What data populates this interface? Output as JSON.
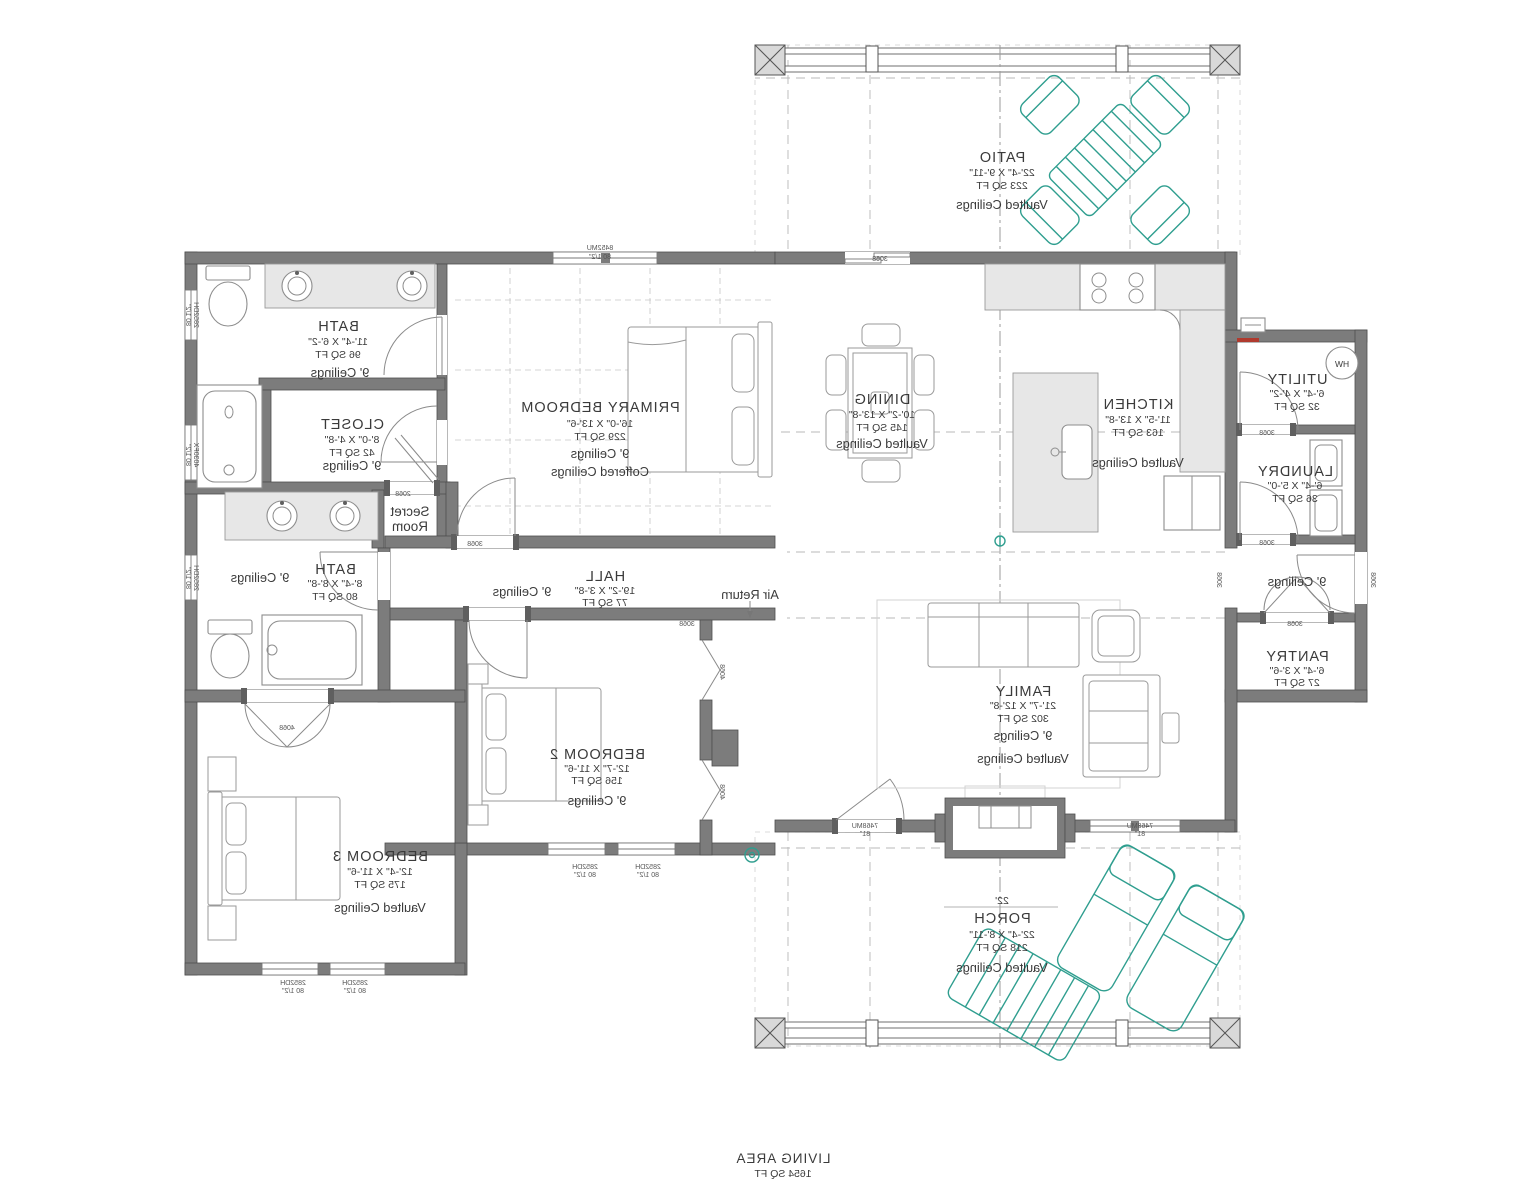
{
  "plan": {
    "rooms": {
      "bath_primary": {
        "name": "BATH",
        "dims": "11'-4\" X 6'-2\"",
        "area": "96 SQ FT",
        "ceiling": "9' Ceilings"
      },
      "closet_primary": {
        "name": "CLOSET",
        "dims": "8'-0\" X 4'-8\"",
        "area": "42 SQ FT",
        "ceiling": "9' Ceilings"
      },
      "secret_room": {
        "line1": "Secret",
        "line2": "Room"
      },
      "primary_bedroom": {
        "name": "PRIMARY BEDROOM",
        "dims": "16'-0\" X 13'-6\"",
        "area": "229 SQ FT",
        "ceiling": "9' Ceilings",
        "ceiling2": "Coffered Ceilings"
      },
      "hall": {
        "name": "HALL",
        "dims": "19'-2\" X 3'-8\"",
        "area": "77 SQ FT",
        "ceiling": "9' Ceilings"
      },
      "bath2": {
        "name": "BATH",
        "dims": "8'-4\" X 8'-8\"",
        "area": "80 SQ FT",
        "ceiling": "9' Ceilings"
      },
      "bedroom2": {
        "name": "BEDROOM 2",
        "dims": "12'-7\" X 11'-6\"",
        "area": "156 SQ FT",
        "ceiling": "9' Ceilings"
      },
      "bedroom3": {
        "name": "BEDROOM 3",
        "dims": "12'-4\" X 11'-6\"",
        "area": "175 SQ FT",
        "ceiling": "Vaulted Ceilings"
      },
      "dining": {
        "name": "DINING",
        "dims": "10'-2\" X 13'-8\"",
        "area": "145 SQ FT",
        "ceiling": "Vaulted Ceilings"
      },
      "kitchen": {
        "name": "KITCHEN",
        "dims": "11'-5\" X 13'-8\"",
        "area": "163 SQ FT",
        "ceiling": "Vaulted Ceilings"
      },
      "family": {
        "name": "FAMILY",
        "dims": "21'-7\" X 12'-8\"",
        "area": "302 SQ FT",
        "ceiling": "9' Ceilings",
        "ceiling2": "Vaulted Ceilings"
      },
      "utility": {
        "name": "UTILITY",
        "dims": "6'-4\" X 4'-2\"",
        "area": "32 SQ FT"
      },
      "laundry": {
        "name": "LAUNDRY",
        "dims": "6'-4\" X 5'-0\"",
        "area": "36 SQ FT"
      },
      "hall2": {
        "ceiling": "9' Ceilings"
      },
      "pantry": {
        "name": "PANTRY",
        "dims": "6'-4\" X 3'-6\"",
        "area": "27 SQ FT"
      },
      "patio": {
        "name": "PATIO",
        "dims": "22'-4\" X 9'-11\"",
        "area": "223 SQ FT",
        "ceiling": "Vaulted Ceilings"
      },
      "porch": {
        "width_note": "22'",
        "name": "PORCH",
        "dims": "22'-4\" X 8'-11\"",
        "area": "218 SQ FT",
        "ceiling": "Vaulted Ceilings"
      }
    },
    "annotations": {
      "air_return": "Air Return",
      "water_heater": "HW"
    },
    "totals": {
      "label": "LIVING AREA",
      "area": "1654 SQ FT"
    },
    "openings": {
      "win_primary_top": {
        "code": "8452MU",
        "header": "80 1/2\""
      },
      "win_bath_side": {
        "code": "2852DH",
        "header": "80 1/2\""
      },
      "win_tub_side": {
        "code": "4030FX",
        "header": "80 1/2\""
      },
      "win_bath2_side": {
        "code": "2852DH",
        "header": "80 1/2\""
      },
      "win_bed2_a": {
        "code": "2852DH",
        "header": "80 1/2\""
      },
      "win_bed2_b": {
        "code": "2852DH",
        "header": "80 1/2\""
      },
      "win_bed3_a": {
        "code": "2852DH",
        "header": "80 1/2\""
      },
      "win_bed3_b": {
        "code": "2852DH",
        "header": "80 1/2\""
      },
      "win_family_a": {
        "code": "7468MU",
        "header": "81\""
      },
      "win_family_b": {
        "code": "7468MU",
        "header": "81\""
      },
      "door_patio": {
        "code": "3068"
      },
      "door_primary": {
        "code": "3068"
      },
      "door_bed2": {
        "code": "3068"
      },
      "door_secret": {
        "code": "2068"
      },
      "door_bed3": {
        "code": "4068"
      },
      "door_closet2_a": {
        "code": "4068"
      },
      "door_closet2_b": {
        "code": "4068"
      },
      "door_utility": {
        "code": "3068"
      },
      "door_laundry": {
        "code": "3068"
      },
      "door_pantry": {
        "code": "3068"
      },
      "door_hall2_in": {
        "code": "3068"
      },
      "door_hall2_out": {
        "code": "3068"
      }
    },
    "colors": {
      "teal": "#2f9e8f",
      "wall_gray": "#7c7c7c",
      "accent_red": "#b03a2e"
    }
  }
}
